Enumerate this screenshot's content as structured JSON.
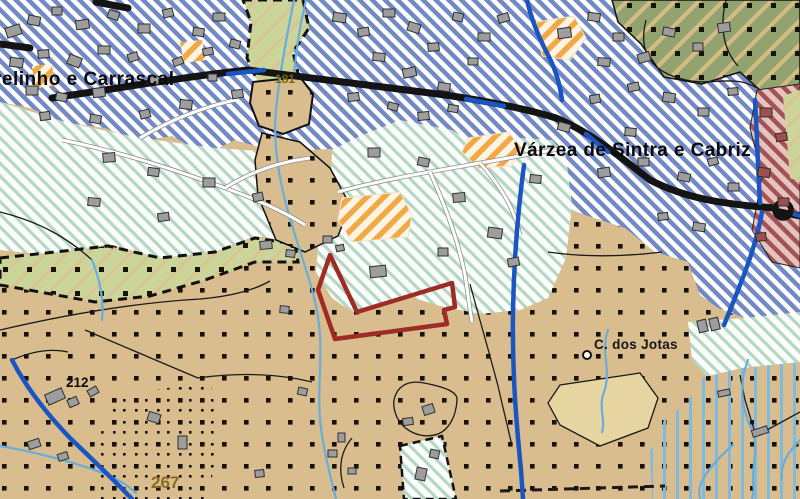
{
  "map": {
    "colors": {
      "tan_base": "#d9bd8e",
      "dot": "#17120a",
      "urban_stripe": "#7289c3",
      "urban_bg": "#ffffff",
      "teal_stripe": "#b5d6c4",
      "teal_bg": "#fbfdfb",
      "olive_base": "#92a36f",
      "olive_stripe": "#d5bc85",
      "yg_base": "#cbd599",
      "yg_stripe": "#d9c493",
      "orange_stripe": "#f2a844",
      "orange_bg": "#fdf4e3",
      "maroon_stripe": "#a25356",
      "maroon_bg": "#e7c3c0",
      "flood_stripe": "#7fbadf",
      "road_black": "#141414",
      "road_blue": "#1a55c4",
      "stream_blue": "#67aede",
      "white_road": "#ffffff",
      "white_road_casing": "#8f8f8f",
      "building_fill": "#9d9d9d",
      "building_stroke": "#2f2f2f",
      "building_maroon": "#9c5050",
      "parcel_red": "#9e2b24",
      "boundary": "#1a1a1a"
    },
    "labels": [
      {
        "id": "parish-left",
        "text": "relinho e Carrascal",
        "x": -6,
        "y": 85,
        "size": 19,
        "weight": "bold",
        "color": "#0b0b0b",
        "spacing": 0.5
      },
      {
        "id": "parish-right",
        "text": "Várzea de Sintra e Cabriz",
        "x": 514,
        "y": 156,
        "size": 19,
        "weight": "bold",
        "color": "#0b0b0b",
        "spacing": 0.4
      },
      {
        "id": "place-jotas",
        "text": "C. dos Jotas",
        "x": 594,
        "y": 349,
        "size": 13.5,
        "weight": "600",
        "color": "#151515",
        "spacing": 0.3
      },
      {
        "id": "elev-212",
        "text": "212",
        "x": 66,
        "y": 387,
        "size": 13.5,
        "weight": "bold",
        "color": "#0b0b0b",
        "spacing": 0
      },
      {
        "id": "elev-267",
        "text": "267",
        "x": 151,
        "y": 488,
        "size": 17,
        "weight": "bold",
        "color": "#8a6a1c",
        "spacing": 0
      },
      {
        "id": "road-181",
        "text": "181",
        "x": 275,
        "y": 83,
        "size": 12,
        "weight": "bold",
        "color": "#7a6408",
        "spacing": 0
      }
    ],
    "zones": [
      {
        "name": "urban-residential-hatch",
        "fill": "blueH",
        "points": "0,0 800,0 800,330 760,332 745,318 718,308 700,295 688,262 655,252 625,228 585,215 560,205 548,172 522,166 500,188 472,182 458,162 430,168 405,152 382,162 345,148 312,150 285,140 262,148 235,140 205,155 172,136 140,142 105,128 62,122 30,108 0,102"
      },
      {
        "name": "forest-olive",
        "fill": "oliveH",
        "overlay": "dotsT",
        "stroke": "#111111",
        "sw": 1.5,
        "points": "612,0 800,0 800,88 762,92 740,72 702,84 664,77 641,44 618,22"
      },
      {
        "name": "zone-maroon",
        "fill": "maroonH",
        "stroke": "#222222",
        "sw": 1,
        "points": "757,90 800,84 800,268 772,262 752,230 762,176 750,128"
      },
      {
        "name": "yg-right-strip",
        "fill": "ygH",
        "points": "783,96 800,90 800,182 790,178"
      },
      {
        "name": "teal-left",
        "fill": "tealH",
        "points": "0,102 65,122 140,138 215,148 272,152 308,162 338,180 352,205 330,232 295,242 255,236 215,252 160,258 108,244 55,256 0,250"
      },
      {
        "name": "teal-center",
        "fill": "tealH",
        "points": "332,150 360,136 400,120 452,130 470,142 520,138 552,140 566,156 572,205 566,258 548,298 520,310 480,314 440,306 408,296 372,308 352,312 332,298 316,272 318,248 330,213"
      },
      {
        "name": "teal-right",
        "fill": "tealH",
        "points": "688,322 745,318 800,312 800,395 752,388 712,382 692,360"
      },
      {
        "name": "yg-top",
        "fill": "ygH",
        "stroke": "#111111",
        "sw": 3,
        "dash": "9,6",
        "points": "243,0 303,0 309,28 293,52 301,86 263,93 247,58 251,22"
      },
      {
        "name": "yg-left",
        "fill": "ygH",
        "overlay": "dotsT",
        "stroke": "#111111",
        "sw": 3,
        "dash": "9,6",
        "points": "0,258 55,252 108,246 160,258 215,252 255,238 295,244 298,262 255,262 205,280 150,296 95,302 40,292 0,285"
      },
      {
        "name": "tan-patch-181",
        "fill": "dotsTan",
        "stroke": "#111111",
        "sw": 2,
        "points": "253,82 300,77 313,94 309,124 283,134 259,126 250,103"
      },
      {
        "name": "tan-corridor",
        "fill": "dotsTan",
        "stroke": "#111111",
        "sw": 1.5,
        "points": "262,133 300,142 330,168 350,205 338,236 305,252 276,240 258,196 255,160"
      },
      {
        "name": "orange-equip-1",
        "fill": "orangeH",
        "stroke": "#eee3cc",
        "sw": 1,
        "points": "342,198 400,192 412,215 408,237 352,242 338,220"
      },
      {
        "name": "orange-equip-2",
        "fill": "orangeH",
        "stroke": "#eee3cc",
        "sw": 1,
        "points": "468,138 508,132 522,148 512,166 478,168 462,152"
      },
      {
        "name": "orange-equip-3",
        "fill": "orangeH",
        "stroke": "#eee3cc",
        "sw": 1,
        "points": "536,22 574,16 586,38 570,60 542,56"
      },
      {
        "name": "orange-equip-4",
        "fill": "orangeH",
        "points": "180,42 202,40 206,60 184,63"
      },
      {
        "name": "orange-equip-5",
        "fill": "orangeH",
        "points": "32,66 52,64 55,86 35,88"
      },
      {
        "name": "flood-vertical-stripes",
        "fill": "dotsTan",
        "overlay": "vstripeT",
        "points": "652,499 650,452 664,420 688,402 700,378 742,368 800,362 800,499"
      },
      {
        "name": "dense-dots",
        "fill": "dotsDense",
        "points": "118,395 210,382 222,445 205,499 100,499 95,445"
      },
      {
        "name": "pale-patch-jotas",
        "fill": "#e8d6a2",
        "stroke": "#1a1a1a",
        "sw": 1.3,
        "points": "560,385 640,373 658,398 648,428 600,446 560,425 548,403"
      },
      {
        "name": "teal-patch-bottom",
        "fill": "tealH",
        "stroke": "#111111",
        "sw": 2.5,
        "dash": "8,5",
        "points": "400,446 442,436 456,499 404,499"
      }
    ],
    "white_roads": [
      "M 62,140 C 120,152 170,168 225,188 C 258,200 285,212 305,225",
      "M 338,192 C 380,180 430,172 480,163 C 510,158 540,152 565,148",
      "M 430,172 C 445,205 458,240 465,275 C 468,295 470,310 472,322",
      "M 225,188 C 250,172 280,162 310,158",
      "M 140,138 C 170,120 200,108 235,100",
      "M 480,163 C 500,185 515,210 520,235"
    ],
    "black_roads": [
      "M 52,98 C 120,88 190,76 248,70 C 300,76 360,84 430,93 C 470,98 520,107 556,118 C 590,132 618,155 650,180 C 685,198 720,204 775,208",
      "M 780,212 L 800,216",
      "M 96,2 L 128,8",
      "M 0,44 L 30,48"
    ],
    "blue_roads": [
      "M 12,360 C 25,385 45,412 70,438 C 95,462 112,478 132,499",
      "M 524,165 C 518,210 514,260 513,310 C 512,370 516,420 521,470 L 523,499",
      "M 755,100 C 757,135 758,170 760,203",
      "M 762,212 C 758,235 750,260 740,285 C 733,303 728,315 724,325",
      "M 791,213 L 800,216",
      "M 527,0 C 531,18 538,36 548,55 C 556,70 560,85 562,100",
      "M 228,74 L 264,70",
      "M 466,99 L 504,106",
      "M 586,134 L 608,152"
    ],
    "streams": [
      "M 294,0 C 288,30 280,70 276,110 C 272,150 282,195 295,235 C 305,268 318,300 320,335 C 322,370 316,400 322,435 C 326,462 332,482 336,499",
      "M 306,0 C 300,25 296,50 294,75",
      "M 0,446 C 35,452 75,462 105,474 C 120,480 128,486 136,493",
      "M 748,360 C 738,385 742,410 752,430 C 760,448 750,470 754,490 L 752,499",
      "M 733,445 C 718,458 705,472 700,486 C 698,492 700,496 700,499",
      "M 800,440 C 788,452 780,465 782,478",
      "M 608,330 C 600,352 612,370 604,392 C 598,408 606,420 602,432",
      "M 92,260 C 100,280 104,300 102,320"
    ],
    "boundaries": [
      "M 0,330 C 60,316 130,303 200,299 C 235,296 256,289 270,281",
      "M 470,284 C 478,314 488,348 498,386 C 503,408 508,428 512,446",
      "M 0,212 C 40,222 68,238 92,260",
      "M 85,330 C 120,345 160,362 198,378",
      "M 740,375 L 745,400 L 756,436 L 800,412",
      "M 12,360 C 30,352 50,348 68,352",
      "M 198,378 C 240,372 280,374 312,382",
      "M 646,20 C 638,52 650,72 686,80 C 712,86 734,74 757,88",
      "M 726,0 C 720,24 722,48 738,66",
      "M 396,394 C 400,385 410,380 424,383 C 445,387 458,392 457,400 C 456,418 448,430 438,434 C 420,440 402,430 396,415 C 393,407 393,400 396,394",
      "M 352,438 C 340,452 338,470 344,488",
      "M 548,252 C 590,258 630,256 662,252"
    ],
    "dashed_boundaries": [
      "M 500,491 L 665,486"
    ],
    "buildings": [
      [
        6,
        26,
        15,
        10,
        -18
      ],
      [
        28,
        16,
        12,
        9,
        12
      ],
      [
        52,
        7,
        10,
        8,
        0
      ],
      [
        76,
        20,
        13,
        9,
        -8
      ],
      [
        108,
        11,
        11,
        8,
        18
      ],
      [
        138,
        24,
        12,
        9,
        0
      ],
      [
        163,
        9,
        10,
        8,
        -14
      ],
      [
        10,
        58,
        13,
        9,
        8
      ],
      [
        38,
        50,
        11,
        8,
        -5
      ],
      [
        68,
        56,
        13,
        10,
        22
      ],
      [
        98,
        46,
        12,
        8,
        0
      ],
      [
        128,
        53,
        10,
        8,
        -18
      ],
      [
        26,
        86,
        12,
        9,
        0
      ],
      [
        56,
        93,
        11,
        8,
        12
      ],
      [
        93,
        88,
        12,
        9,
        -8
      ],
      [
        148,
        76,
        11,
        8,
        5
      ],
      [
        173,
        58,
        10,
        7,
        -22
      ],
      [
        193,
        28,
        11,
        8,
        8
      ],
      [
        213,
        13,
        12,
        8,
        0
      ],
      [
        203,
        48,
        10,
        7,
        -12
      ],
      [
        208,
        74,
        9,
        7,
        0
      ],
      [
        230,
        40,
        10,
        8,
        14
      ],
      [
        232,
        90,
        11,
        8,
        -10
      ],
      [
        180,
        100,
        12,
        9,
        6
      ],
      [
        140,
        110,
        10,
        8,
        -15
      ],
      [
        90,
        115,
        11,
        8,
        10
      ],
      [
        40,
        112,
        10,
        8,
        -8
      ],
      [
        333,
        13,
        13,
        9,
        8
      ],
      [
        358,
        28,
        11,
        8,
        -10
      ],
      [
        383,
        9,
        12,
        8,
        0
      ],
      [
        408,
        23,
        12,
        9,
        18
      ],
      [
        428,
        43,
        11,
        8,
        -5
      ],
      [
        453,
        13,
        10,
        8,
        12
      ],
      [
        478,
        33,
        12,
        8,
        0
      ],
      [
        498,
        14,
        11,
        8,
        -18
      ],
      [
        373,
        53,
        12,
        8,
        5
      ],
      [
        403,
        68,
        13,
        9,
        -12
      ],
      [
        438,
        83,
        12,
        8,
        8
      ],
      [
        468,
        58,
        10,
        7,
        0
      ],
      [
        348,
        93,
        11,
        8,
        -8
      ],
      [
        388,
        103,
        10,
        7,
        16
      ],
      [
        418,
        112,
        11,
        8,
        -6
      ],
      [
        448,
        105,
        10,
        7,
        10
      ],
      [
        558,
        28,
        13,
        10,
        -8
      ],
      [
        588,
        13,
        12,
        8,
        8
      ],
      [
        613,
        33,
        11,
        8,
        0
      ],
      [
        638,
        53,
        12,
        9,
        -16
      ],
      [
        663,
        28,
        12,
        8,
        12
      ],
      [
        693,
        43,
        10,
        8,
        0
      ],
      [
        718,
        23,
        12,
        9,
        -8
      ],
      [
        598,
        58,
        12,
        8,
        5
      ],
      [
        628,
        83,
        11,
        8,
        -12
      ],
      [
        663,
        93,
        12,
        9,
        8
      ],
      [
        698,
        108,
        11,
        8,
        0
      ],
      [
        728,
        88,
        10,
        7,
        -5
      ],
      [
        558,
        123,
        12,
        8,
        16
      ],
      [
        598,
        168,
        12,
        9,
        -8
      ],
      [
        638,
        158,
        11,
        8,
        0
      ],
      [
        678,
        173,
        12,
        8,
        12
      ],
      [
        708,
        158,
        10,
        7,
        -16
      ],
      [
        728,
        183,
        11,
        8,
        0
      ],
      [
        693,
        223,
        12,
        8,
        8
      ],
      [
        658,
        213,
        10,
        7,
        -8
      ],
      [
        625,
        128,
        11,
        8,
        5
      ],
      [
        590,
        95,
        10,
        8,
        -10
      ],
      [
        103,
        153,
        12,
        9,
        -5
      ],
      [
        148,
        168,
        11,
        8,
        8
      ],
      [
        203,
        178,
        12,
        9,
        0
      ],
      [
        253,
        193,
        10,
        8,
        -12
      ],
      [
        88,
        198,
        12,
        8,
        5
      ],
      [
        158,
        213,
        11,
        8,
        -8
      ],
      [
        368,
        148,
        12,
        9,
        0
      ],
      [
        418,
        158,
        11,
        8,
        12
      ],
      [
        453,
        193,
        12,
        9,
        -5
      ],
      [
        488,
        228,
        14,
        10,
        8
      ],
      [
        508,
        258,
        11,
        8,
        -10
      ],
      [
        438,
        248,
        10,
        8,
        0
      ],
      [
        530,
        175,
        11,
        8,
        6
      ],
      [
        370,
        266,
        16,
        11,
        -6
      ],
      [
        323,
        236,
        9,
        7,
        0
      ],
      [
        336,
        245,
        8,
        6,
        -12
      ],
      [
        260,
        241,
        12,
        8,
        -5
      ],
      [
        286,
        250,
        9,
        7,
        8
      ],
      [
        280,
        306,
        9,
        7,
        5
      ],
      [
        46,
        391,
        18,
        11,
        -24
      ],
      [
        68,
        398,
        10,
        8,
        -24
      ],
      [
        28,
        440,
        12,
        8,
        -18
      ],
      [
        58,
        453,
        10,
        7,
        -18
      ],
      [
        88,
        388,
        10,
        7,
        -30
      ],
      [
        148,
        413,
        12,
        9,
        18
      ],
      [
        178,
        436,
        9,
        13,
        0
      ],
      [
        328,
        450,
        9,
        7,
        0
      ],
      [
        348,
        468,
        8,
        6,
        0
      ],
      [
        403,
        418,
        10,
        7,
        -8
      ],
      [
        298,
        388,
        9,
        7,
        12
      ],
      [
        338,
        433,
        7,
        9,
        0
      ],
      [
        255,
        470,
        9,
        7,
        -6
      ],
      [
        760,
        108,
        12,
        9,
        0,
        "m"
      ],
      [
        776,
        133,
        11,
        8,
        -8,
        "m"
      ],
      [
        758,
        168,
        12,
        9,
        8,
        "m"
      ],
      [
        778,
        198,
        11,
        8,
        0,
        "m"
      ],
      [
        756,
        233,
        10,
        8,
        -5,
        "m"
      ],
      [
        416,
        468,
        10,
        12,
        12
      ],
      [
        430,
        450,
        9,
        8,
        12
      ],
      [
        718,
        390,
        12,
        6,
        -12
      ],
      [
        752,
        428,
        16,
        7,
        -18
      ],
      [
        698,
        320,
        9,
        12,
        -14
      ],
      [
        710,
        318,
        9,
        12,
        -14
      ],
      [
        423,
        405,
        11,
        9,
        -18
      ]
    ],
    "markers": {
      "roundabout": {
        "cx": 783,
        "cy": 210,
        "r": 8
      },
      "well": {
        "cx": 587,
        "cy": 355,
        "r": 4
      }
    },
    "parcel": {
      "points": "330,255 357,312 452,283 455,307 444,310 447,324 335,339 318,290",
      "color": "#9e2b24",
      "width": 4.5
    }
  }
}
